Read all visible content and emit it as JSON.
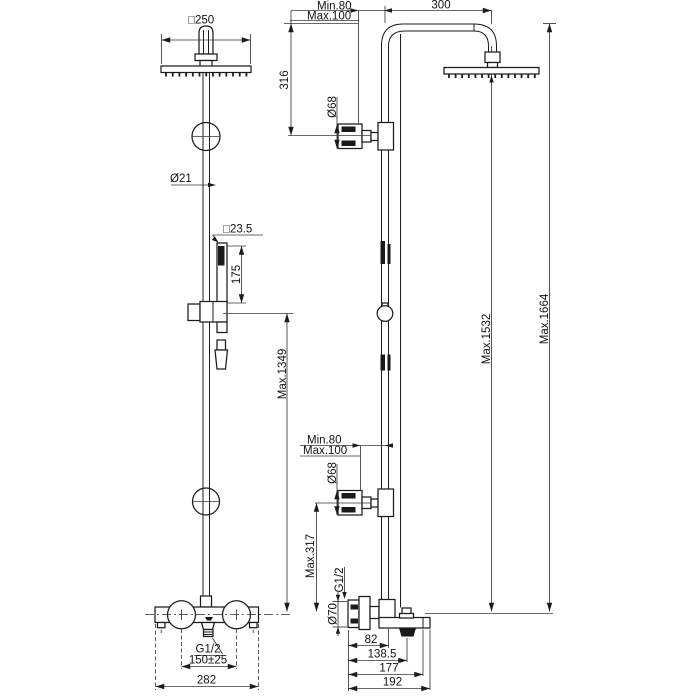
{
  "drawing": {
    "background": "#ffffff",
    "line_color": "#1c1c1c",
    "description_labels": {
      "side_view": {
        "head_width": "□250",
        "pipe_diameter": "Ø21",
        "handshower_size": "□23.5",
        "handshower_length": "175",
        "max_height_handshower": "Max.1349",
        "outlet_thread": "G1/2",
        "inlet_spacing": "150±25",
        "valve_width": "282"
      },
      "front_view": {
        "wall_distance_min_top": "Min.80",
        "wall_distance_max_top": "Max.100",
        "arm_reach": "300",
        "arm_drop": "316",
        "bracket_diameter_top": "Ø68",
        "max_height_head": "Max.1532",
        "max_height_total": "Max.1664",
        "wall_distance_min_mid": "Min.80",
        "wall_distance_max_mid": "Max.100",
        "bracket_diameter_mid": "Ø68",
        "max_height_lower": "Max.317",
        "supply_thread": "G1/2",
        "escutcheon_diameter": "Ø70",
        "depth_pipe": "82",
        "depth_outlet": "138.5",
        "depth_body": "177",
        "depth_total": "192"
      }
    }
  }
}
